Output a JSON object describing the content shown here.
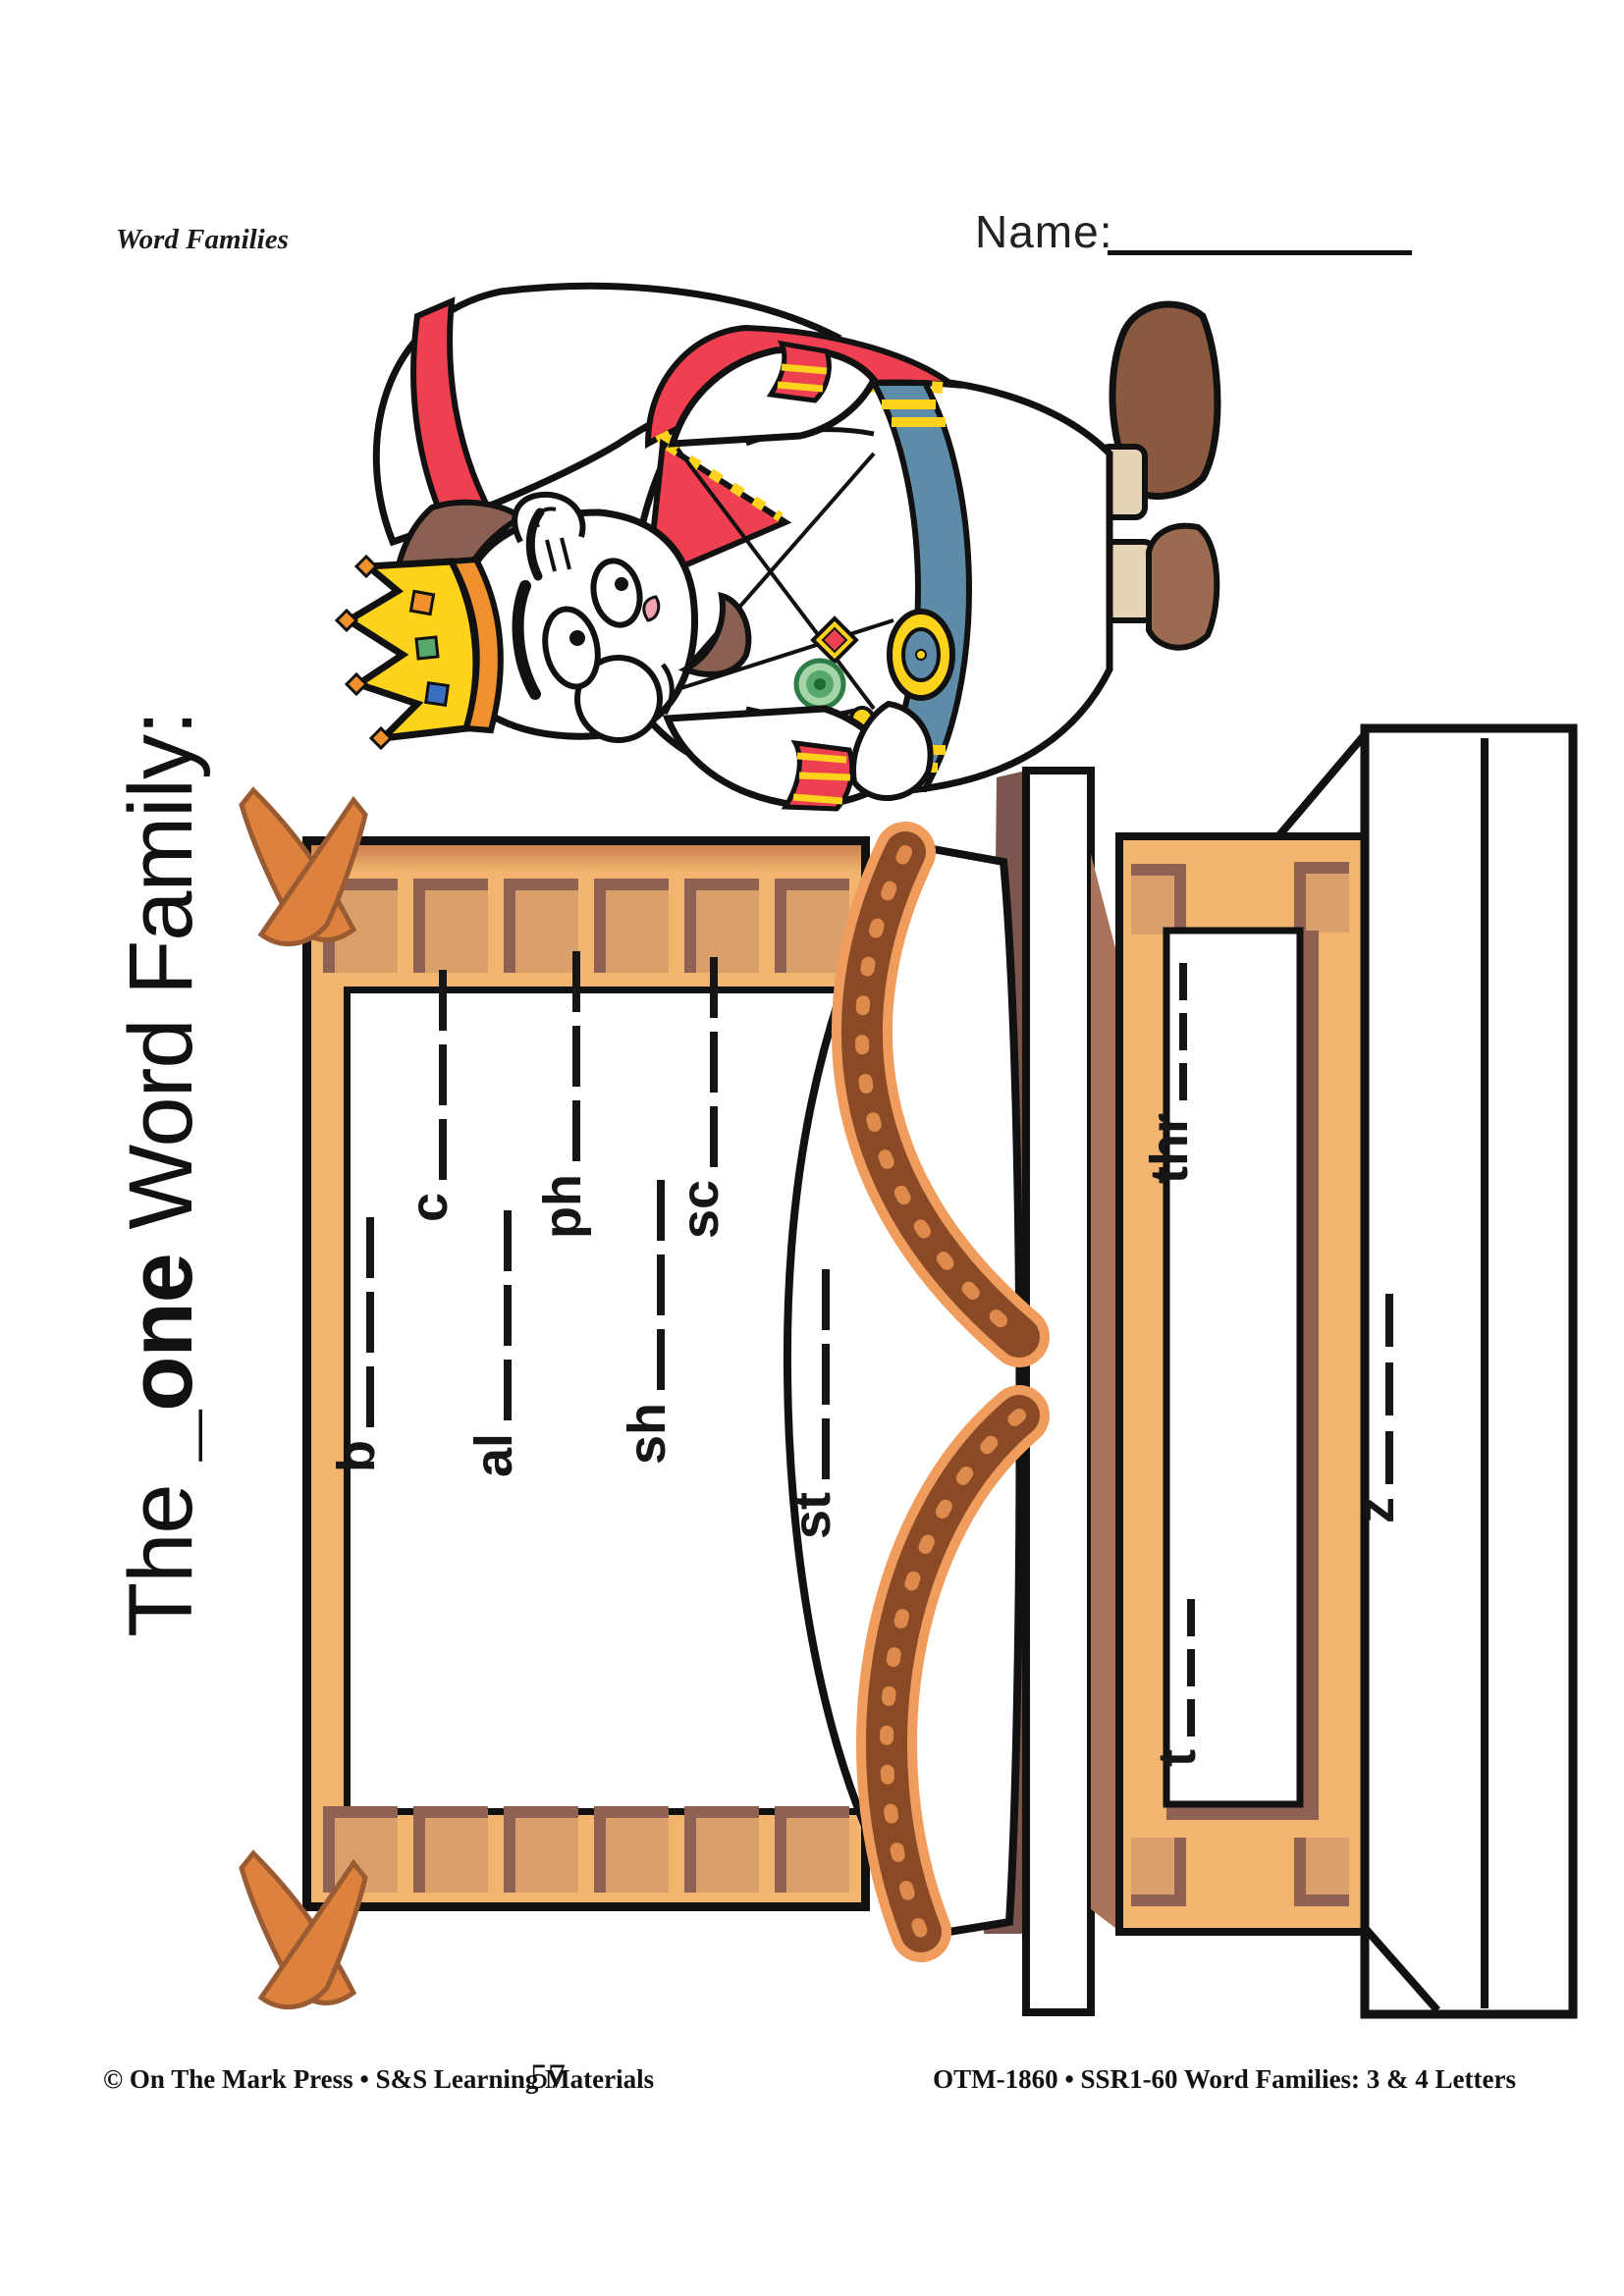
{
  "header": {
    "category_label": "Word Families",
    "name_label": "Name:"
  },
  "title": {
    "prefix": "The ",
    "family_blank": "_one",
    "suffix": " Word Family:",
    "full": "The _one Word Family:"
  },
  "worksheet": {
    "word_family": "one",
    "prompts": [
      {
        "id": "b",
        "label": "b",
        "blank_segments": 3
      },
      {
        "id": "c",
        "label": "c",
        "blank_segments": 3
      },
      {
        "id": "al",
        "label": "al",
        "blank_segments": 3
      },
      {
        "id": "ph",
        "label": "ph",
        "blank_segments": 3
      },
      {
        "id": "sh",
        "label": "sh",
        "blank_segments": 3
      },
      {
        "id": "sc",
        "label": "sc",
        "blank_segments": 3
      },
      {
        "id": "st",
        "label": "st",
        "blank_segments": 3
      },
      {
        "id": "thr",
        "label": "thr",
        "blank_segments": 3
      },
      {
        "id": "t",
        "label": "t",
        "blank_segments": 3
      },
      {
        "id": "z",
        "label": "z",
        "blank_segments": 3
      }
    ]
  },
  "illustration": {
    "alt": "Cartoon king with crown and red cape standing behind a wooden throne bench"
  },
  "colors": {
    "wood_tan": "#F2B46E",
    "wood_panel": "#D9A06C",
    "wood_shadow": "#8E6152",
    "wood_rail": "#C9804E",
    "ornament_orange": "#DD813C",
    "strap_brown": "#8A4A26",
    "strap_edge": "#F09C5D",
    "king_red": "#EE4050",
    "king_yellow": "#FFD21C",
    "king_belt_blue": "#5E8CA8",
    "outline": "#111111"
  },
  "footer": {
    "copyright": "© On The Mark Press • S&S Learning Materials",
    "page_number": "57",
    "product_code": "OTM-1860 • SSR1-60 Word Families:  3 & 4 Letters"
  }
}
